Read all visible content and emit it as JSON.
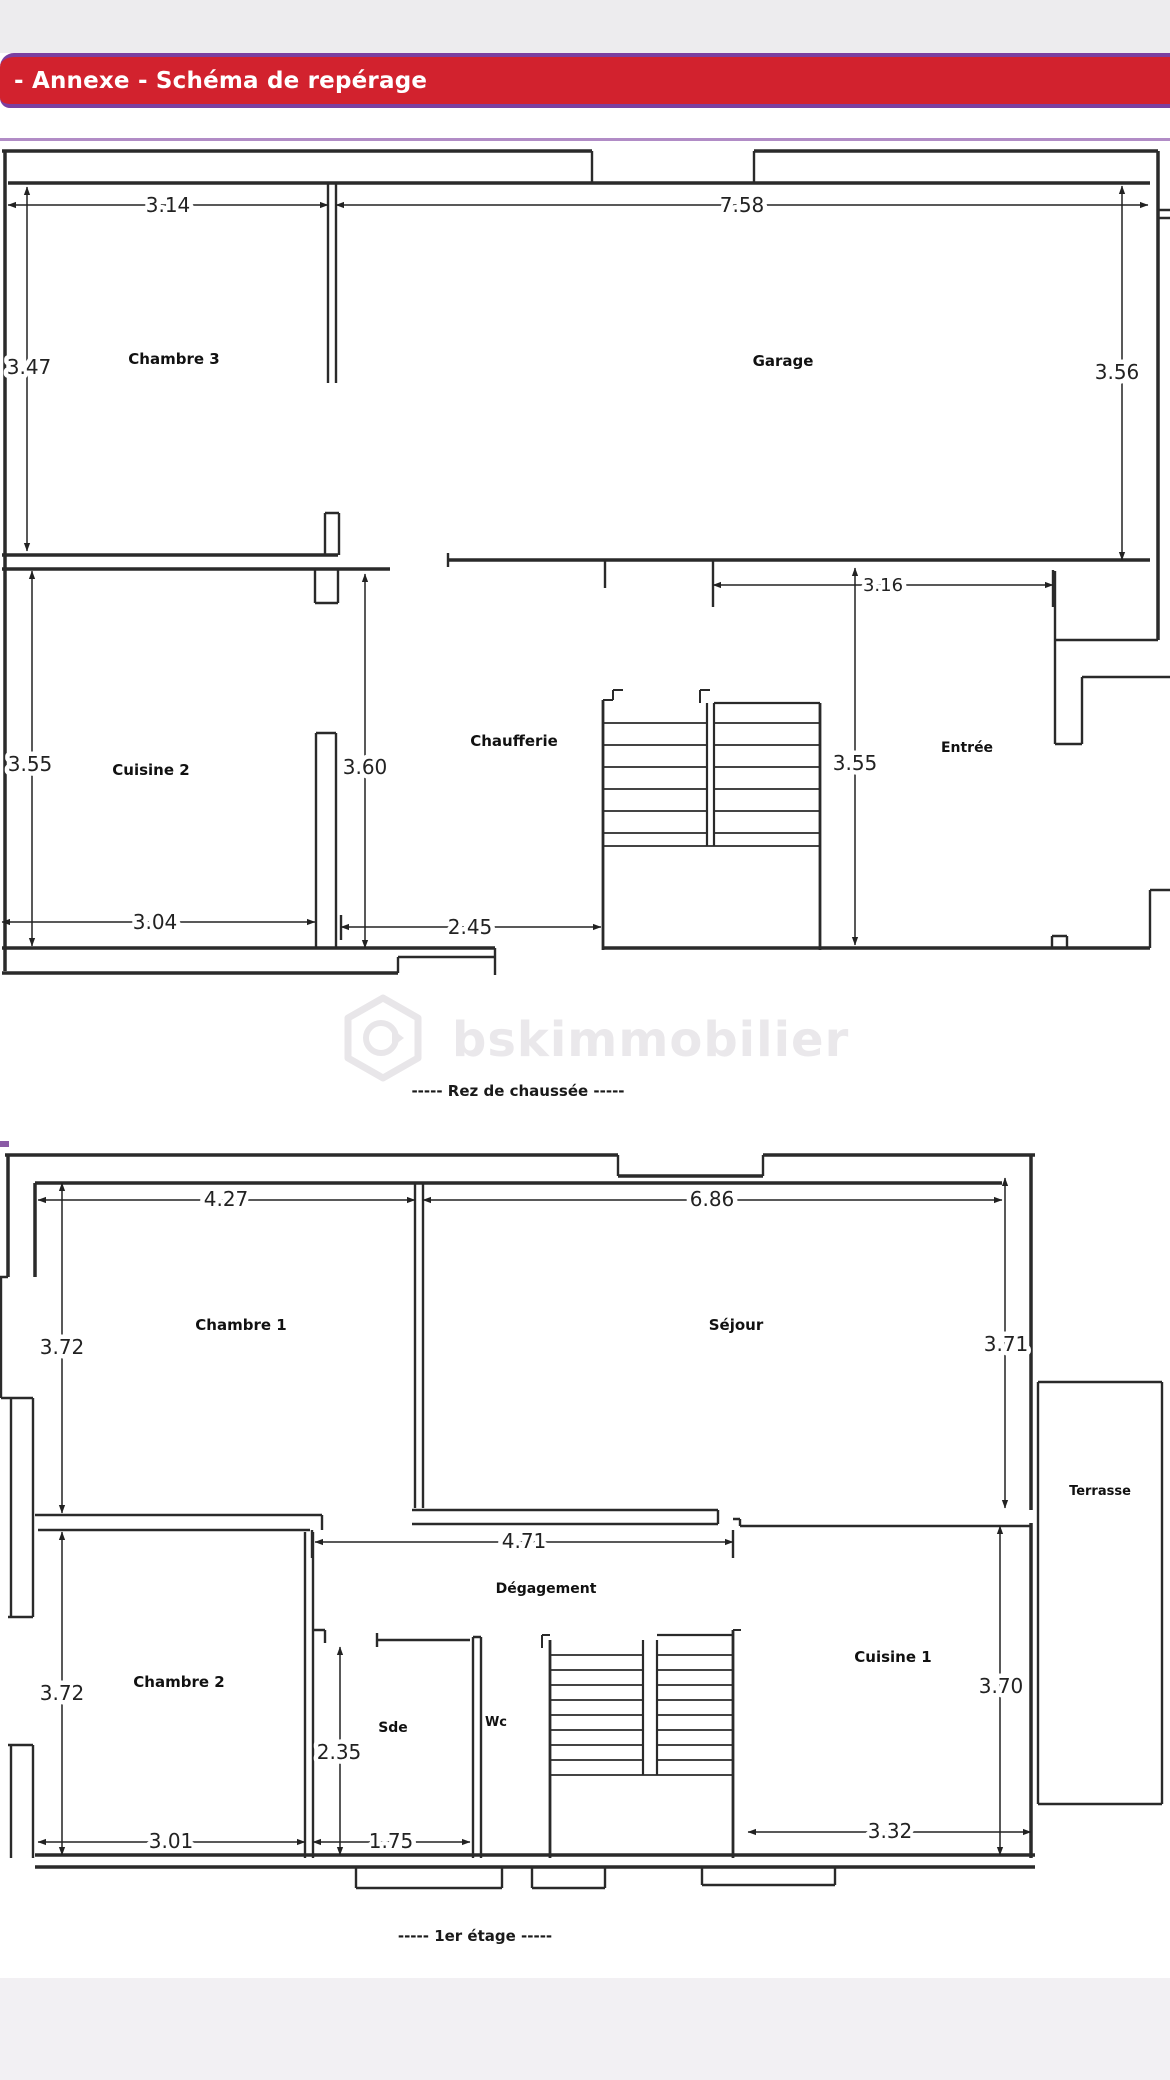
{
  "header": {
    "title": "- Annexe - Schéma de repérage"
  },
  "watermark": {
    "brand": "bskimmobilier"
  },
  "floors": {
    "rdc": {
      "caption": "-----  Rez de chaussée  -----",
      "rooms": {
        "chambre3": "Chambre 3",
        "garage": "Garage",
        "cuisine2": "Cuisine 2",
        "chaufferie": "Chaufferie",
        "entree": "Entrée"
      },
      "dims": {
        "chambre3_width": "3.14",
        "garage_width": "7.58",
        "chambre3_height": "3.47",
        "garage_height": "3.56",
        "cuisine2_height": "3.55",
        "middle_height": "3.60",
        "entree_width": "3.16",
        "entree_height": "3.55",
        "cuisine2_width": "3.04",
        "chaufferie_width": "2.45"
      }
    },
    "etage1": {
      "caption": "-----  1er étage  -----",
      "rooms": {
        "chambre1": "Chambre 1",
        "sejour": "Séjour",
        "degagement": "Dégagement",
        "chambre2": "Chambre 2",
        "sde": "Sde",
        "wc": "Wc",
        "cuisine1": "Cuisine 1",
        "terrasse": "Terrasse"
      },
      "dims": {
        "chambre1_width": "4.27",
        "sejour_width": "6.86",
        "chambre1_height": "3.72",
        "sejour_height": "3.71",
        "degagement_width": "4.71",
        "chambre2_height": "3.72",
        "sde_height": "2.35",
        "chambre2_width": "3.01",
        "sde_width": "1.75",
        "cuisine1_height": "3.70",
        "cuisine1_width": "3.32"
      }
    }
  }
}
